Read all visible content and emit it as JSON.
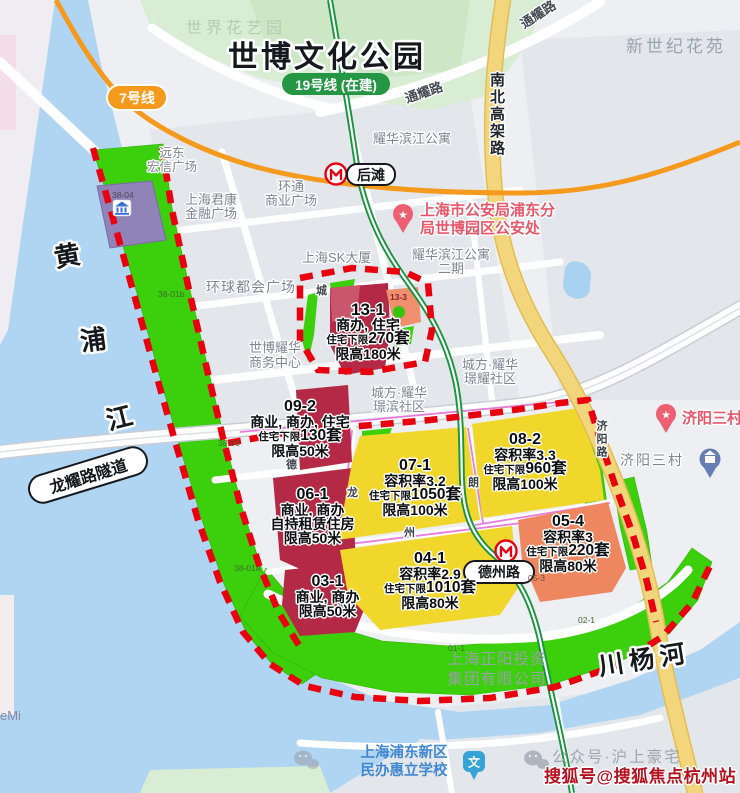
{
  "park": {
    "title": "世博文化公园",
    "sub": "世界花艺园"
  },
  "badges": {
    "line7": "7号线",
    "line19": "19号线 (在建)"
  },
  "stations": {
    "houtan": "后滩",
    "dezhoulu": "德州路"
  },
  "roads": {
    "tongyao_a": "通耀路",
    "tongyao_b": "通耀路",
    "nanbei_gaojia": "南北高架路",
    "longyao_tunnel": "龙耀路隧道",
    "jiyang": "济阳路"
  },
  "rivers": {
    "huangpu_1": "黄",
    "huangpu_2": "浦",
    "huangpu_3": "江",
    "chuanyang": "川杨河"
  },
  "places": {
    "new_century": "新世纪花苑",
    "yuandong_1": "远东",
    "yuandong_2": "宏信广场",
    "junkang_1": "上海君康",
    "junkang_2": "金融广场",
    "huantong_1": "环通",
    "huantong_2": "商业广场",
    "sk_tower": "上海SK大厦",
    "global_metro": "环球都会广场",
    "expo_yaohua_1": "世博耀华",
    "expo_yaohua_2": "商务中心",
    "yaohua_apt": "耀华滨江公寓",
    "yaohua_apt2_1": "耀华滨江公寓",
    "yaohua_apt2_2": "二期",
    "jingyao_1": "城方·耀华",
    "jingyao_2": "璟耀社区",
    "jingbin_1": "城方·耀华",
    "jingbin_2": "璟滨社区",
    "jiyang_village": "济阳三村",
    "jiyang_village_poi": "济阳三村",
    "police_1": "上海市公安局浦东分",
    "police_2": "局世博园区公安处",
    "zhengyang_1": "上海正阳投资",
    "zhengyang_2": "集团有限公司",
    "huili_school_1": "上海浦东新区",
    "huili_school_2": "民办惠立学校",
    "emi": "eMi"
  },
  "parcels": {
    "p13_1": {
      "id": "13-1",
      "use": "商办, 住宅",
      "prefix": "住宅下限",
      "units": "270套",
      "height": "限高180米"
    },
    "p09_2": {
      "id": "09-2",
      "use": "商业, 商办, 住宅",
      "prefix": "住宅下限",
      "units": "130套",
      "height": "限高50米"
    },
    "p06_1": {
      "id": "06-1",
      "use": "商业, 商办",
      "extra": "自持租赁住房",
      "height": "限高50米"
    },
    "p03_1": {
      "id": "03-1",
      "use": "商业, 商办",
      "height": "限高50米"
    },
    "p07_1": {
      "id": "07-1",
      "far": "容积率3.2",
      "prefix": "住宅下限",
      "units": "1050套",
      "height": "限高100米"
    },
    "p08_2": {
      "id": "08-2",
      "far": "容积率3.3",
      "prefix": "住宅下限",
      "units": "960套",
      "height": "限高100米"
    },
    "p04_1": {
      "id": "04-1",
      "far": "容积率2.9",
      "prefix": "住宅下限",
      "units": "1010套",
      "height": "限高80米"
    },
    "p05_4": {
      "id": "05-4",
      "far": "容积率3",
      "prefix": "住宅下限",
      "units": "220套",
      "height": "限高80米"
    }
  },
  "parcel_codes": {
    "c38_04": "38-04",
    "c38_01b": "38-01b",
    "c38_06": "38-06",
    "c38_01a": "38-01a",
    "c01_1": "01-1",
    "c02_1": "02-1",
    "c05_3": "05-3",
    "c13_3": "13-3"
  },
  "road_glyphs": [
    "城",
    "德",
    "龙",
    "州",
    "朗",
    "耀"
  ],
  "watermarks": {
    "wechat_text": "公众号·沪上豪宅",
    "sohu": "搜狐号@搜狐焦点杭州站"
  },
  "icons": {
    "school_glyph": "文",
    "star": "★"
  },
  "colors": {
    "water": "#b0d5f2",
    "park_green": "#d9ecd4",
    "plan_green": "#3ccf0b",
    "parcel_red": "#b42945",
    "parcel_yellow": "#f1d72b",
    "parcel_orange": "#ee8660",
    "parcel_purple": "#8f83b8",
    "boundary_red": "#e8000f",
    "line7_orange": "#f59a1d",
    "line19_green": "#17953e",
    "highway_yellow": "#f3d67b",
    "poi_pink": "#e8576b",
    "poi_blue": "#3f87d2",
    "magenta_road": "#e66fd8",
    "sohu_red": "#b5121f"
  }
}
